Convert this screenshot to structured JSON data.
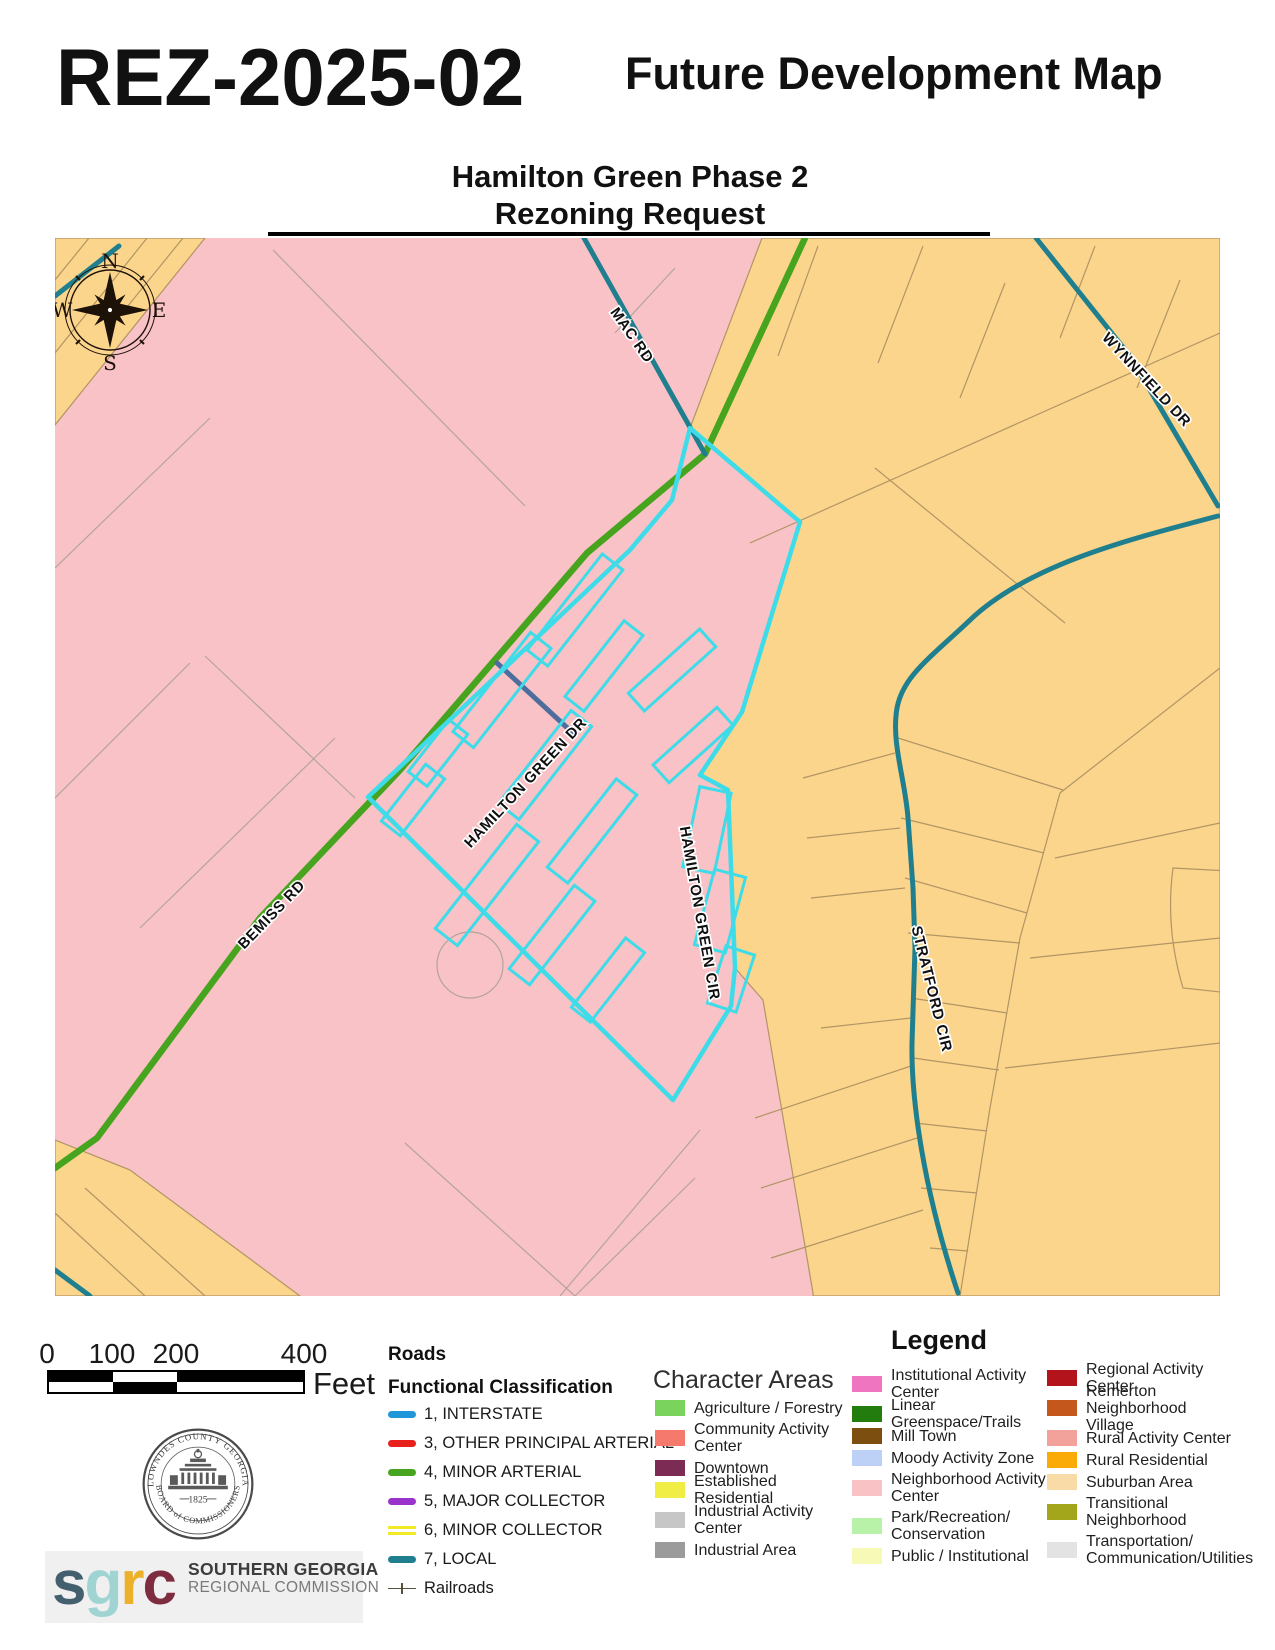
{
  "header": {
    "case_number": "REZ-2025-02",
    "map_title": "Future Development Map",
    "subtitle_line1": "Hamilton Green Phase 2",
    "subtitle_line2": "Rezoning Request"
  },
  "map": {
    "road_labels": {
      "mac": "MAC RD",
      "wynnfield": "WYNNFIELD DR",
      "bemiss": "BEMISS RD",
      "hamilton_green_dr": "HAMILTON GREEN DR",
      "hamilton_green_cir": "HAMILTON GREEN CIR",
      "stratford": "STRATFORD CIR"
    },
    "compass": {
      "n": "N",
      "e": "E",
      "s": "S",
      "w": "W"
    },
    "colors": {
      "zone_neighborhood_activity_center": "#f8c2c6",
      "zone_suburban_area": "#fbd58b",
      "road_minor_arterial": "#46a41e",
      "road_local": "#1f7f8e",
      "road_city_street": "#4d6e9d",
      "site_outline_cyan": "#3edce9",
      "parcel_line_pink_zone": "#b5a49a",
      "parcel_line_orange_zone": "#b29565"
    }
  },
  "scale_bar": {
    "labels": [
      "0",
      "100",
      "200",
      "400"
    ],
    "unit": "Feet"
  },
  "roads_legend": {
    "title": "Roads",
    "subtitle": "Functional Classification",
    "items": [
      {
        "label": "1, INTERSTATE",
        "color": "#2196d8",
        "style": "solid"
      },
      {
        "label": "3, OTHER PRINCIPAL ARTERIAL",
        "color": "#e8211d",
        "style": "solid"
      },
      {
        "label": "4, MINOR ARTERIAL",
        "color": "#46a41e",
        "style": "solid"
      },
      {
        "label": "5, MAJOR COLLECTOR",
        "color": "#9933cc",
        "style": "solid"
      },
      {
        "label": "6, MINOR COLLECTOR",
        "color": "#f2ea27",
        "style": "double"
      },
      {
        "label": "7, LOCAL",
        "color": "#1f7f8e",
        "style": "solid"
      },
      {
        "label": "Railroads",
        "color": "#55503a",
        "style": "railroad"
      }
    ]
  },
  "legend": {
    "title": "Legend",
    "character_areas_title": "Character Areas",
    "col1": [
      {
        "label": "Agriculture / Forestry",
        "color": "#7ad35c"
      },
      {
        "label": "Community Activity\nCenter",
        "color": "#f5796d"
      },
      {
        "label": "Downtown",
        "color": "#7c2b55"
      },
      {
        "label": "Established Residential",
        "color": "#f0ed45"
      },
      {
        "label": "Industrial Activity\nCenter",
        "color": "#c6c6c6"
      },
      {
        "label": "Industrial Area",
        "color": "#9b9b9b"
      }
    ],
    "col2": [
      {
        "label": "Institutional Activity\nCenter",
        "color": "#f075c1"
      },
      {
        "label": "Linear Greenspace/Trails",
        "color": "#237c0e"
      },
      {
        "label": "Mill Town",
        "color": "#7c4f10"
      },
      {
        "label": "Moody Activity Zone",
        "color": "#bdd1f7"
      },
      {
        "label": "Neighborhood Activity\nCenter",
        "color": "#f9c2c4"
      },
      {
        "label": "Park/Recreation/\nConservation",
        "color": "#b8f2a8"
      },
      {
        "label": "Public / Institutional",
        "color": "#f7f9b6"
      }
    ],
    "col3": [
      {
        "label": "Regional Activity Center",
        "color": "#b3131b"
      },
      {
        "label": "Remerton Neighborhood\nVillage",
        "color": "#c3571c"
      },
      {
        "label": "Rural Activity Center",
        "color": "#f2a29b"
      },
      {
        "label": "Rural Residential",
        "color": "#fbab07"
      },
      {
        "label": "Suburban Area",
        "color": "#f8dba6"
      },
      {
        "label": "Transitional\nNeighborhood",
        "color": "#a3a61a"
      },
      {
        "label": "Transportation/\nCommunication/Utilities",
        "color": "#e3e3e3"
      }
    ]
  },
  "seal": {
    "arc_top": "LOWNDES COUNTY GEORGIA",
    "arc_bottom": "BOARD of COMMISSIONERS",
    "year": "1825"
  },
  "sgrc": {
    "letters": [
      {
        "char": "s",
        "color": "#44606e"
      },
      {
        "char": "g",
        "color": "#9fd4d2"
      },
      {
        "char": "r",
        "color": "#edb02a"
      },
      {
        "char": "c",
        "color": "#7d2d3f"
      }
    ],
    "name_line1": "SOUTHERN GEORGIA",
    "name_line2": "REGIONAL COMMISSION"
  }
}
